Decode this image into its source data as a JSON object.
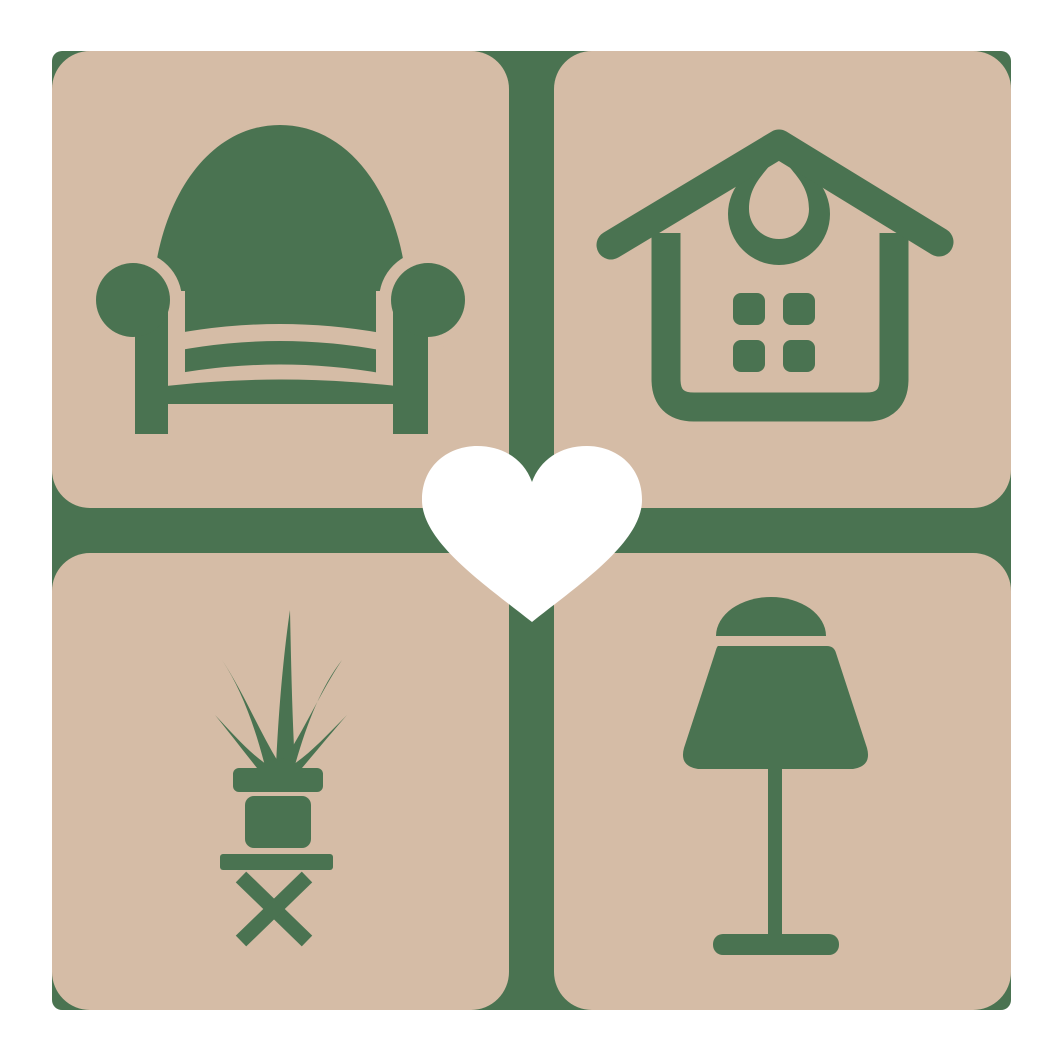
{
  "page": {
    "background_color": "#ffffff"
  },
  "logo": {
    "description": "home-decor-heart-logo",
    "backdrop_color": "#4a7351",
    "tile_color": "#d5bca6",
    "heart_color": "#ffffff",
    "grid": {
      "rows": 2,
      "cols": 2
    },
    "tiles": [
      {
        "position": "top-left",
        "icon": "armchair-icon"
      },
      {
        "position": "top-right",
        "icon": "house-icon"
      },
      {
        "position": "bottom-left",
        "icon": "potted-plant-on-stool-icon"
      },
      {
        "position": "bottom-right",
        "icon": "table-lamp-icon"
      }
    ],
    "center_icon": "heart-icon"
  }
}
